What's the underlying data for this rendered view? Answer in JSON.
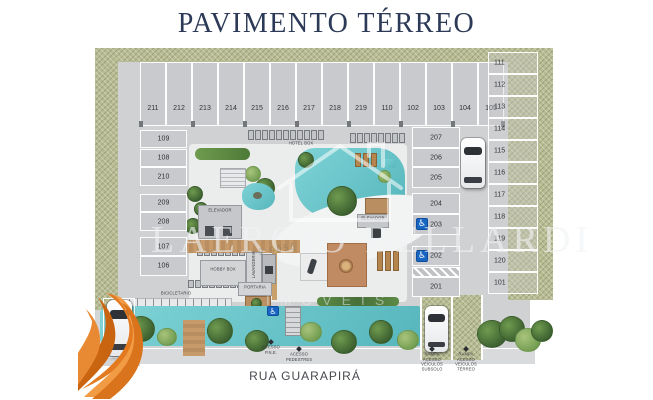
{
  "page": {
    "title": "PAVIMENTO TÉRREO",
    "street": "RUA GUARAPIRÁ"
  },
  "watermark": {
    "name": "LAERCIO BELLARDI",
    "tagline": "IMÓVEIS",
    "phone_fragment": "9 9955"
  },
  "parking": {
    "top_row": [
      "211",
      "212",
      "213",
      "214",
      "215",
      "216",
      "217",
      "218",
      "219",
      "110",
      "102",
      "103",
      "104",
      "105"
    ],
    "left_column": [
      "109",
      "108",
      "210",
      "209",
      "208",
      "107",
      "106"
    ],
    "mid_column": [
      "207",
      "206",
      "205",
      "204",
      "203",
      "202",
      "201"
    ],
    "right_column": [
      "111",
      "112",
      "113",
      "114",
      "115",
      "116",
      "117",
      "118",
      "119",
      "120",
      "101"
    ]
  },
  "amenities": {
    "elevator_a": "ELEVADOR",
    "elevator_b": "ELEVADOR",
    "hobby_box": "HOBBY BOX",
    "laundry": "LAVANDERIA",
    "front_desk": "PORTARIA",
    "bike_parking": "BICICLETÁRIO",
    "hotel_box": "HOTEL BOX"
  },
  "access": {
    "pne": "ACESSO P.N.E.",
    "pedestrian": "ACESSO PEDESTRES",
    "ramp_basement": "RAMPA ACESSO VEÍCULOS SUBSOLO",
    "ramp_ground": "RAMPA ACESSO VEÍCULOS TÉRREO"
  },
  "icons": {
    "wheelchair": "♿"
  },
  "colors": {
    "title_navy": "#2c3a57",
    "water_teal": "#63c0c6",
    "landscape_green": "#b8bc93",
    "accessible_blue": "#1966c2",
    "ribbon_orange": "#e87b22"
  }
}
